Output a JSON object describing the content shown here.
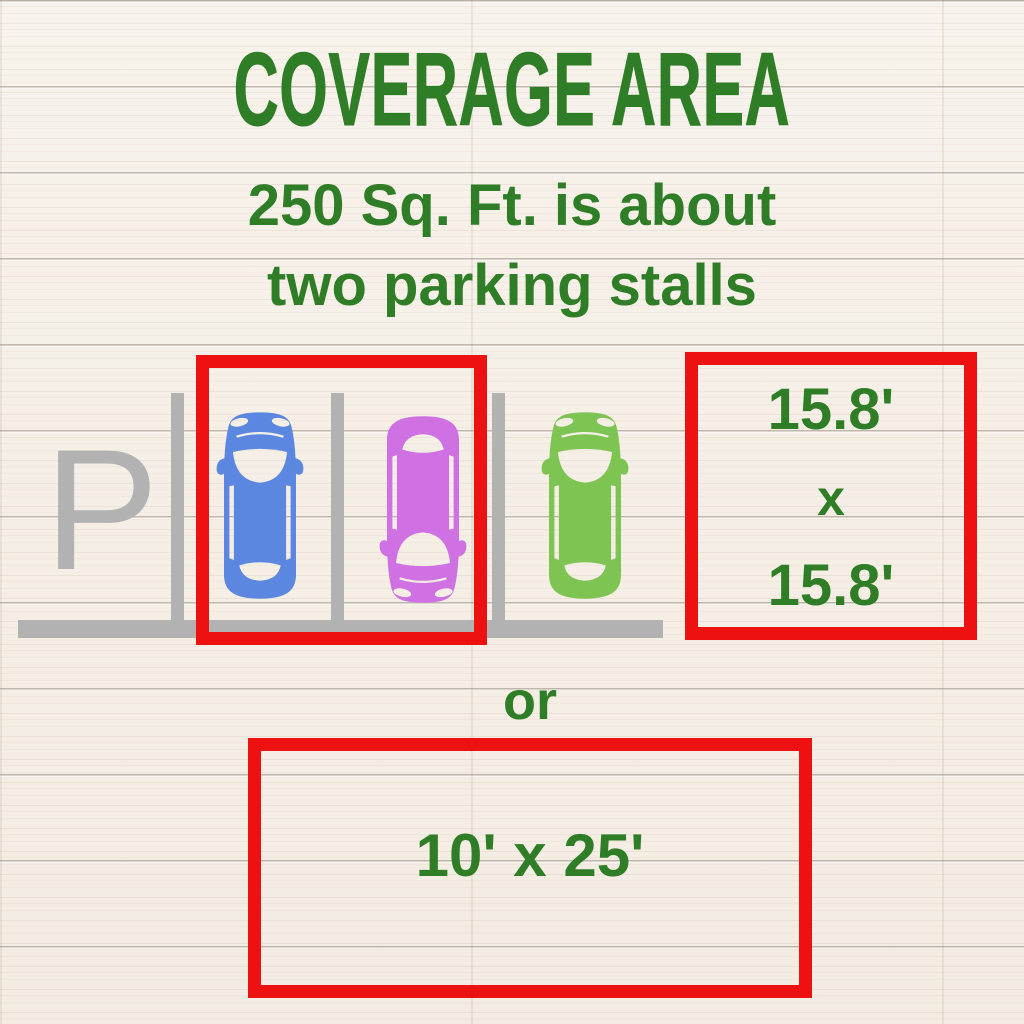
{
  "title": "COVERAGE AREA",
  "subtitle": {
    "line1": "250 Sq. Ft. is about",
    "line2": "two parking stalls"
  },
  "parking_lot": {
    "sign_letter": "P",
    "cars": [
      {
        "name": "blue-car",
        "color": "#5b87e0",
        "facing": "up"
      },
      {
        "name": "magenta-car",
        "color": "#cf70e3",
        "facing": "down"
      },
      {
        "name": "green-car",
        "color": "#7dc453",
        "facing": "up"
      }
    ],
    "structure_color": "#b2b2b2",
    "highlight_outline_color": "#ee1111"
  },
  "square_equivalent": {
    "width_label": "15.8'",
    "separator": "x",
    "height_label": "15.8'"
  },
  "or_label": "or",
  "rectangle_equivalent": {
    "label": "10' x 25'"
  },
  "colors": {
    "text_green": "#2f7d26",
    "outline_red": "#ee1111",
    "structure_gray": "#b2b2b2",
    "wood_base": "#f5f0e9"
  }
}
